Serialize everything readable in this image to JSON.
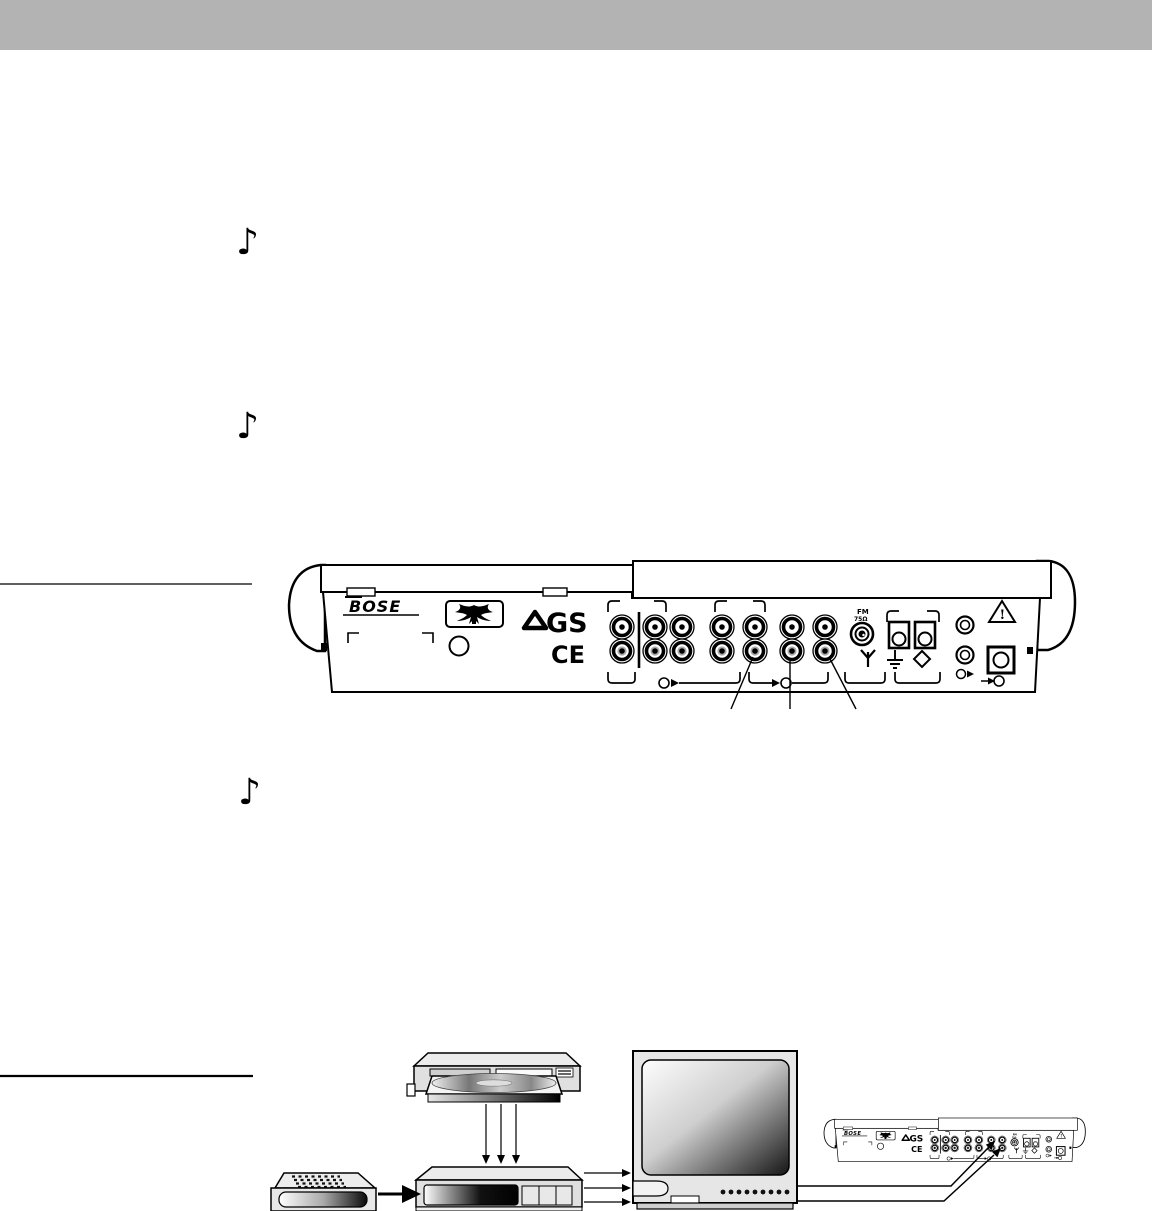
{
  "page": {
    "header_color": "#b3b3b3",
    "background_color": "#ffffff"
  },
  "decorations": {
    "music_note_glyph": "♪",
    "music_note_count": 3,
    "left_rule_count": 2
  },
  "rear_panel": {
    "brand": "BOSE",
    "safety_marks": {
      "gs": "GS",
      "ce": "CE",
      "warning_exclamation": "!"
    },
    "fm_antenna_label": {
      "line1": "FM",
      "line2": "75Ω"
    },
    "connector_rows": 2,
    "rca_columns": 7
  },
  "hookup_diagram": {
    "components": [
      {
        "name": "cd-dvd-player"
      },
      {
        "name": "vcr"
      },
      {
        "name": "tv"
      },
      {
        "name": "remote-control"
      },
      {
        "name": "media-center-rear-panel"
      }
    ]
  }
}
